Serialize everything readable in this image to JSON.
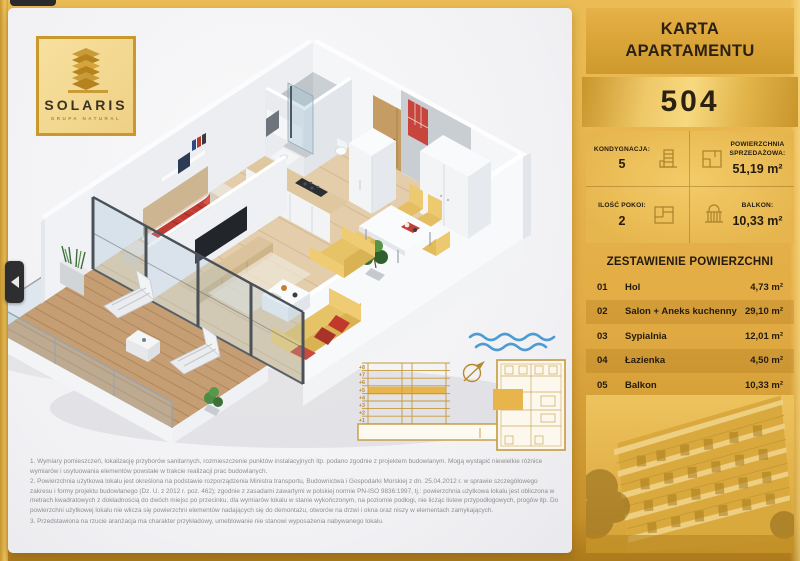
{
  "brand": {
    "name": "SOLARIS",
    "subtitle": "GRUPA NATURAL"
  },
  "header": {
    "title_line1": "KARTA",
    "title_line2": "APARTAMENTU",
    "apartment_number": "504"
  },
  "stats": {
    "kondygnacja": {
      "label": "KONDYGNACJA:",
      "value": "5"
    },
    "powierzchnia": {
      "label_line1": "POWIERZCHNIA",
      "label_line2": "SPRZEDAŻOWA:",
      "value": "51,19 m²"
    },
    "pokoje": {
      "label": "ILOŚĆ POKOI:",
      "value": "2"
    },
    "balkon": {
      "label": "BALKON:",
      "value": "10,33 m²"
    }
  },
  "areas": {
    "title": "ZESTAWIENIE POWIERZCHNI",
    "rows": [
      {
        "num": "01",
        "name": "Hol",
        "value": "4,73 m²"
      },
      {
        "num": "02",
        "name": "Salon + Aneks kuchenny",
        "value": "29,10 m²"
      },
      {
        "num": "03",
        "name": "Sypialnia",
        "value": "12,01 m²"
      },
      {
        "num": "04",
        "name": "Łazienka",
        "value": "4,50 m²"
      },
      {
        "num": "05",
        "name": "Balkon",
        "value": "10,33 m²"
      }
    ]
  },
  "section_diagram": {
    "floors": [
      "+8",
      "+7",
      "+6",
      "+5",
      "+4",
      "+3",
      "+2",
      "+1"
    ],
    "highlighted_floor": "+5"
  },
  "footnotes": [
    "1. Wymiary pomieszczeń, lokalizację przyborów sanitarnych, rozmieszczenie punktów instalacyjnych itp. podano zgodnie z projektem budowlanym. Mogą wystąpić niewielkie różnice wymiarów i usytuowania elementów powstałe w trakcie realizacji prac budowlanych.",
    "2. Powierzchnia użytkowa lokalu jest określona na podstawie rozporządzenia Ministra transportu, Budownictwa i Gospodarki Morskiej z dn. 25.04.2012 r. w sprawie szczegółowego zakresu i formy projektu budowlanego (Dz. U. z 2012 r. poz. 462); zgodnie z zasadami zawartymi w polskiej normie PN-ISO 9836:1997, tj.: powierzchnia użytkowa lokalu jest obliczona w metrach kwadratowych z dokładnością do dwóch miejsc po przecinku, dla wymiarów lokalu w stanie wykończonym, na poziomie podłogi, nie licząc listew przypodłogowych, progów itp. Do powierzchni użytkowej lokalu nie wlicza się powierzchni elementów nadających się do demontażu, otworów na drzwi i okna oraz niszy w elementach zamykających.",
    "3. Przedstawiona na rzucie aranżacja ma charakter przykładowy, umeblowanie nie stanowi wyposażenia nabywanego lokalu."
  ],
  "colors": {
    "gold": "#E3AC45",
    "gold_dark": "#C8952B",
    "text_dark": "#2B2113",
    "accent_red": "#C23A33",
    "wave_blue": "#4E9AD2",
    "diagram_gold": "#C49A3F",
    "highlight_gold": "#E8B54D"
  }
}
